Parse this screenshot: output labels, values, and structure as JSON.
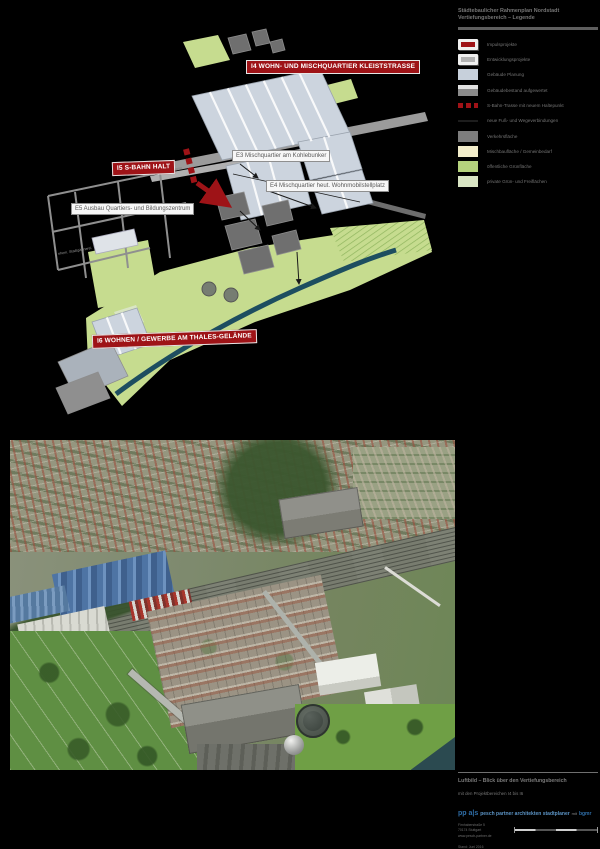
{
  "page": {
    "background": "#000000"
  },
  "plan": {
    "banners": [
      {
        "id": "I4",
        "label": "I4 WOHN- UND MISCHQUARTIER KLEISTSTRASSE"
      },
      {
        "id": "I5",
        "label": "I5 S-BAHN  HALT"
      },
      {
        "id": "I6",
        "label": "I6 WOHNEN / GEWERBE AM THALES-GELÄNDE"
      }
    ],
    "callouts": [
      {
        "id": "E3",
        "label": "E3 Mischquartier am Kohlebunker"
      },
      {
        "id": "E4",
        "label": "E4 Mischquartier heut. Wohnmobilstellplatz"
      },
      {
        "id": "E5",
        "label": "E5 Ausbau Quartiers- und Bildungszentrum"
      }
    ],
    "note": "ehem. Stadtgärtnerei",
    "colors": {
      "accent_red": "#9e1317",
      "planned_building": "#ccd4de",
      "existing_building": "#6f6f6f",
      "traffic": "#9b9b9b",
      "public_green": "#c6dc8f",
      "private_green": "#d9e5c4",
      "river": "#1d4e60"
    }
  },
  "legend": {
    "title_line1": "Städtebaulicher Rahmenplan Nordstadt",
    "title_line2": "Vertiefungsbereich – Legende",
    "items": [
      {
        "swatch": "red-banner-swatch",
        "label": "Impulsprojekte"
      },
      {
        "swatch": "white-banner-swatch",
        "label": "Entwicklungsprojekte"
      },
      {
        "swatch": "planned-building-swatch",
        "label": "Gebäude Planung"
      },
      {
        "swatch": "existing-building-swatch",
        "label": "Gebäudebestand aufgewertet"
      },
      {
        "swatch": "sbahn-line-swatch",
        "label": "S-Bahn-Trasse mit neuem Haltepunkt"
      },
      {
        "swatch": "path-line-swatch",
        "label": "neue Fuß- und Wegeverbindungen"
      },
      {
        "swatch": "traffic-area-swatch",
        "label": "Verkehrsfläche"
      },
      {
        "swatch": "mixed-use-swatch",
        "label": "Mischbaufläche / Gemeinbedarf"
      },
      {
        "swatch": "public-green-swatch",
        "label": "öffentliche Grünfläche"
      },
      {
        "swatch": "private-green-swatch",
        "label": "private Grün- und Freiflächen"
      }
    ]
  },
  "footer": {
    "caption_title": "Luftbild – Blick über den Vertiefungsbereich",
    "caption_sub": "mit den Projektbereichen I4 bis I6",
    "logo_main": "pp a|s",
    "logo_rest": "pesch partner architekten stadtplaner",
    "logo_note": "mit",
    "logo_partner": "bgmr",
    "address_1": "Firnhaberstraße 5",
    "address_2": "70174 Stuttgart",
    "address_3": "www.pesch-partner.de",
    "date_line": "Stand: Juni 2016"
  }
}
